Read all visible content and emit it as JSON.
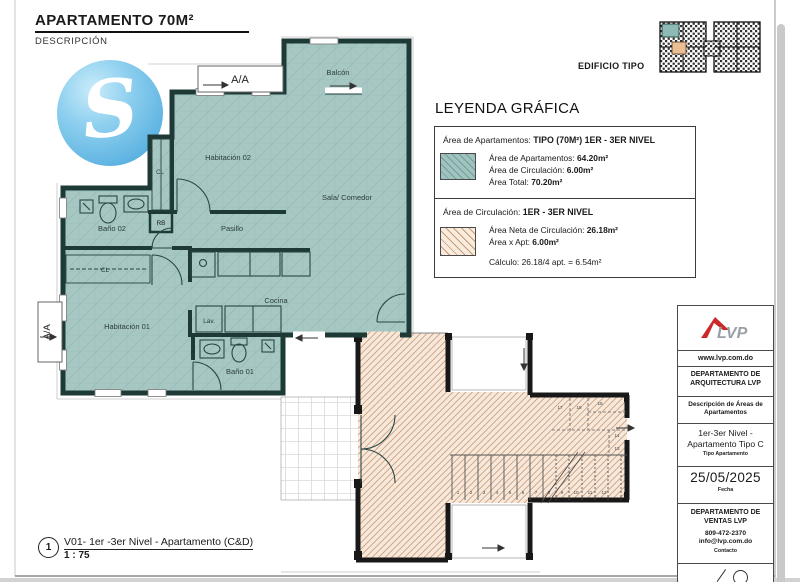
{
  "page": {
    "title": "APARTAMENTO 70M²",
    "subtitle": "DESCRIPCIÓN"
  },
  "watermark": {
    "letter": "S"
  },
  "key_plan": {
    "label": "EDIFICIO TIPO"
  },
  "legend": {
    "title": "LEYENDA GRÁFICA",
    "apartments": {
      "header_label": "Área de Apartamentos:",
      "header_value": "TIPO (70M²) 1ER - 3ER NIVEL",
      "rows": [
        {
          "label": "Área de Apartamentos:",
          "value": "64.20m²"
        },
        {
          "label": "Área de Circulación:",
          "value": "6.00m²"
        },
        {
          "label": "Área Total:",
          "value": "70.20m²"
        }
      ]
    },
    "circulation": {
      "header_label": "Área de Circulación:",
      "header_value": "1ER - 3ER NIVEL",
      "rows": [
        {
          "label": "Área Neta de Circulación:",
          "value": "26.18m²"
        },
        {
          "label": "Área x Apt:",
          "value": "6.00m²"
        }
      ],
      "calc_label": "Cálculo:",
      "calc_value": "26.18/4 apt. = 6.54m²"
    }
  },
  "plan": {
    "rooms": {
      "balcon": "Balcón",
      "aa_top": "A/A",
      "aa_left": "A/A",
      "habitacion02": "Habitación 02",
      "cl_upper": "CL",
      "rb": "RB",
      "bano02": "Baño 02",
      "pasillo": "Pasillo",
      "sala_comedor": "Sala/ Comedor",
      "cl_lower": "CL",
      "habitacion01": "Habitación 01",
      "lav": "Lav.",
      "cocina": "Cocina",
      "bano01": "Baño 01"
    },
    "stairs": {
      "treads": [
        "1",
        "2",
        "3",
        "4",
        "5",
        "6",
        "7",
        "8",
        "9",
        "10",
        "11",
        "12"
      ],
      "upper": [
        "17",
        "18",
        "15",
        "14",
        "13"
      ]
    }
  },
  "viewport_title": {
    "number": "1",
    "name": "V01- 1er -3er Nivel - Apartamento (C&D)",
    "scale": "1 : 75"
  },
  "sidebar": {
    "logo_text": "LVP",
    "website": "www.lvp.com.do",
    "dept_arch": "DEPARTAMENTO DE ARQUITECTURA LVP",
    "desc_title": "Descripción de Áreas de Apartamentos",
    "apt_type": "1er-3er Nivel - Apartamento Tipo C",
    "apt_type_label": "Tipo Apartamento",
    "date": "25/05/2025",
    "date_label": "Fecha",
    "dept_ventas": "DEPARTAMENTO DE VENTAS LVP",
    "phone": "809-472-2370",
    "email": "info@lvp.com.do",
    "contact_label": "Contacto",
    "note": "Alguno elementos Arquitectónicos sujetos a cambios."
  },
  "colors": {
    "apartment_fill": "#a7c7c3",
    "apartment_wall": "#1e3a37",
    "circulation_fill": "#f6e9dc",
    "circulation_hatch": "#cf9d76",
    "accent_red": "#cc2a2a",
    "watermark_blue": "#5fb4e2"
  }
}
